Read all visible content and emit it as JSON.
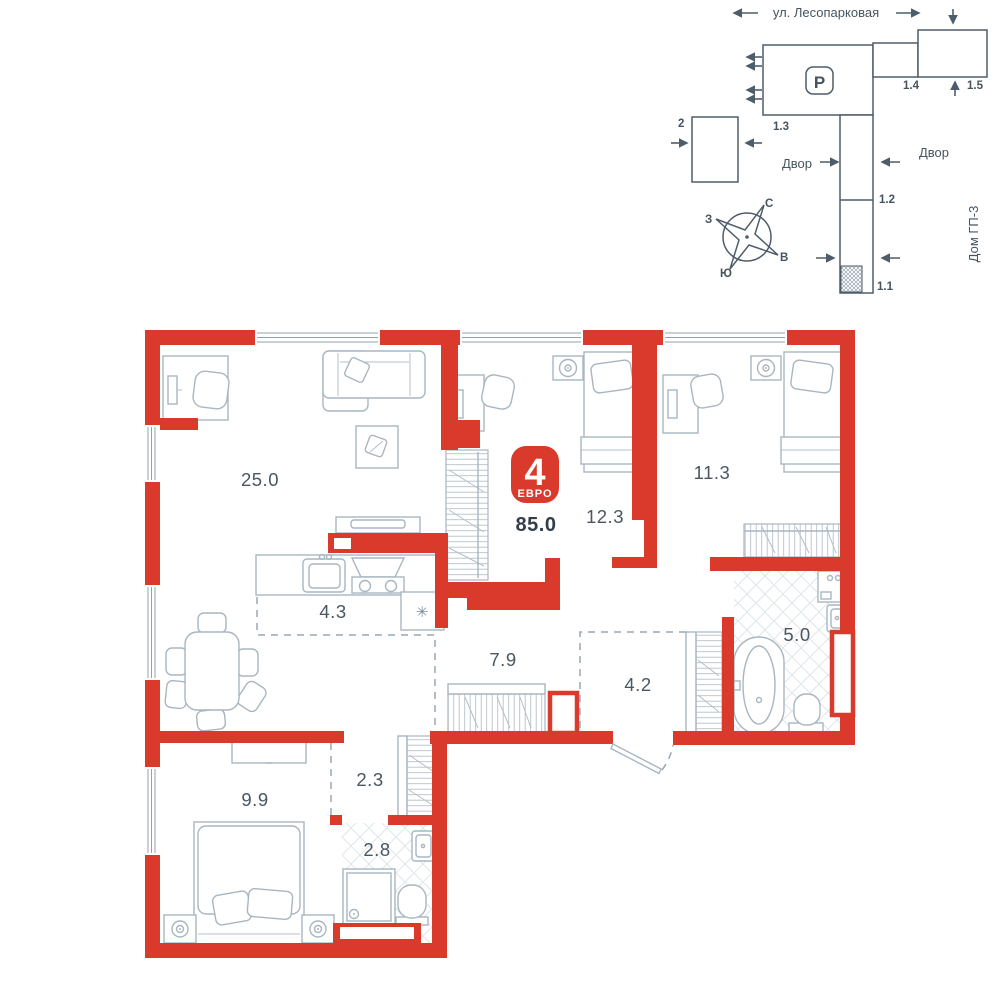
{
  "site_plan": {
    "street_name": "ул. Лесопарковая",
    "parking_label": "P",
    "buildings": {
      "b2": "2",
      "b11": "1.1",
      "b12": "1.2",
      "b13": "1.3",
      "b14": "1.4",
      "b15": "1.5"
    },
    "yard_left": "Двор",
    "yard_right": "Двор",
    "neighbor_house": "Дом ГП-3",
    "compass": {
      "north": "С",
      "south": "Ю",
      "west": "З",
      "east": "В"
    }
  },
  "apartment": {
    "badge": {
      "rooms_count": "4",
      "layout_type": "ЕВРО",
      "total_area": "85.0"
    },
    "rooms": [
      {
        "name": "living-room",
        "area": "25.0"
      },
      {
        "name": "bedroom-1",
        "area": "12.3"
      },
      {
        "name": "bedroom-2",
        "area": "11.3"
      },
      {
        "name": "kitchen",
        "area": "4.3"
      },
      {
        "name": "hallway",
        "area": "7.9"
      },
      {
        "name": "entry",
        "area": "4.2"
      },
      {
        "name": "bathroom",
        "area": "5.0"
      },
      {
        "name": "corridor",
        "area": "2.3"
      },
      {
        "name": "bedroom-3",
        "area": "9.9"
      },
      {
        "name": "shower-room",
        "area": "2.8"
      }
    ],
    "fridge_symbol": "✳"
  },
  "colors": {
    "wall_red": "#d93a2b",
    "furniture_line": "#a9b6c0",
    "tile_line": "#dfe6ea",
    "label_text": "#4a5763",
    "site_line": "#4e5d6a"
  }
}
